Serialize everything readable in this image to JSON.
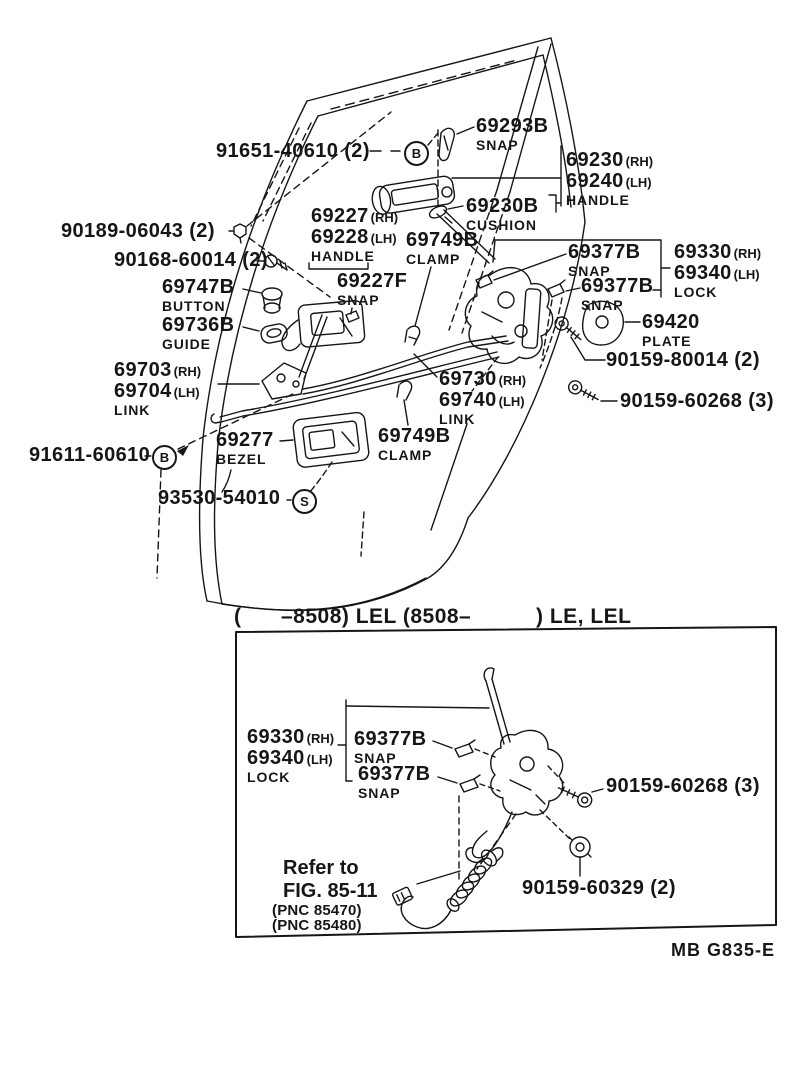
{
  "page": {
    "bg": "#ffffff",
    "ink": "#161616"
  },
  "upper": {
    "labels": [
      {
        "t": "91651-40610 (2)"
      },
      {
        "t": "69293B",
        "c": "SNAP"
      },
      {
        "t": "69230",
        "s": "(RH)"
      },
      {
        "t": "69240",
        "s": "(LH)",
        "c": "HANDLE"
      },
      {
        "t": "69230B",
        "c": "CUSHION"
      },
      {
        "t": "90189-06043 (2)"
      },
      {
        "t": "90168-60014 (2)"
      },
      {
        "t": "69227",
        "s": "(RH)"
      },
      {
        "t": "69228",
        "s": "(LH)",
        "c": "HANDLE"
      },
      {
        "t": "69749B",
        "c": "CLAMP"
      },
      {
        "t": "69377B",
        "c": "SNAP"
      },
      {
        "t": "69330",
        "s": "(RH)"
      },
      {
        "t": "69340",
        "s": "(LH)",
        "c": "LOCK"
      },
      {
        "t": "69377B",
        "c": "SNAP"
      },
      {
        "t": "69747B",
        "c": "BUTTON"
      },
      {
        "t": "69227F",
        "c": "SNAP"
      },
      {
        "t": "69736B",
        "c": "GUIDE"
      },
      {
        "t": "69420",
        "c": "PLATE"
      },
      {
        "t": "90159-80014 (2)"
      },
      {
        "t": "69703",
        "s": "(RH)"
      },
      {
        "t": "69704",
        "s": "(LH)",
        "c": "LINK"
      },
      {
        "t": "69730",
        "s": "(RH)"
      },
      {
        "t": "69740",
        "s": "(LH)",
        "c": "LINK"
      },
      {
        "t": "90159-60268 (3)"
      },
      {
        "t": "91611-60610"
      },
      {
        "t": "69277",
        "c": "BEZEL"
      },
      {
        "t": "69749B",
        "c": "CLAMP"
      },
      {
        "t": "93530-54010"
      }
    ],
    "circles": [
      {
        "letter": "B"
      },
      {
        "letter": "B"
      },
      {
        "letter": "S"
      }
    ]
  },
  "inset": {
    "header": {
      "open": "(",
      "mid": "–8508) LEL (8508–",
      "close": ") LE, LEL"
    },
    "labels": [
      {
        "t": "69330",
        "s": "(RH)"
      },
      {
        "t": "69340",
        "s": "(LH)",
        "c": "LOCK"
      },
      {
        "t": "69377B",
        "c": "SNAP"
      },
      {
        "t": "69377B",
        "c": "SNAP"
      },
      {
        "t": "90159-60268 (3)"
      },
      {
        "t": "Refer to"
      },
      {
        "t": "FIG. 85-11"
      },
      {
        "t": "(PNC 85470)"
      },
      {
        "t": "(PNC 85480)"
      },
      {
        "t": "90159-60329 (2)"
      }
    ]
  },
  "footer": {
    "code": "MB  G835-E"
  }
}
